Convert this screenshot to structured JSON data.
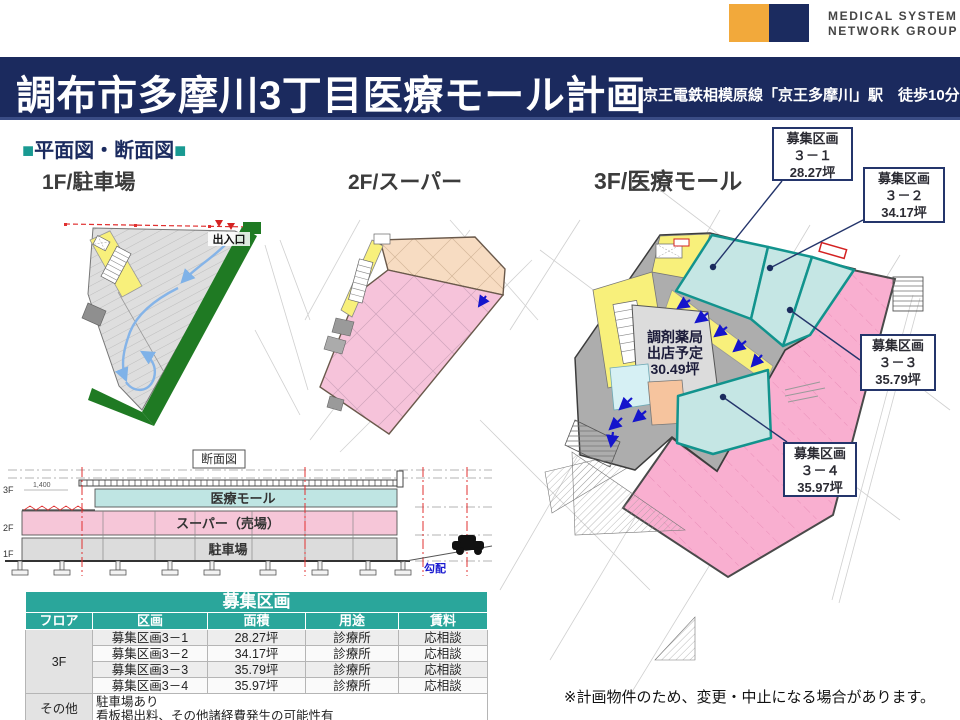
{
  "logo": {
    "line1": "MEDICAL SYSTEM",
    "line2": "NETWORK GROUP",
    "yellow": "#F2A93B",
    "navy": "#1B2B5F"
  },
  "banner": {
    "title": "調布市多摩川3丁目医療モール計画",
    "subtitle": "京王電鉄相模原線「京王多摩川」駅　徒歩10分",
    "bg": "#1B2A5E"
  },
  "section_heading": {
    "marker": "■",
    "label": "平面図・断面図"
  },
  "floor_labels": {
    "f1": "1F/駐車場",
    "f2": "2F/スーパー",
    "f3": "3F/医療モール"
  },
  "plan_1f": {
    "entrance_label": "出入口"
  },
  "plan_3f": {
    "pharmacy_line1": "調剤薬局",
    "pharmacy_line2": "出店予定",
    "pharmacy_line3": "30.49坪"
  },
  "callouts": [
    {
      "title": "募集区画",
      "no": "３－１",
      "area": "28.27坪"
    },
    {
      "title": "募集区画",
      "no": "３－２",
      "area": "34.17坪"
    },
    {
      "title": "募集区画",
      "no": "３－３",
      "area": "35.79坪"
    },
    {
      "title": "募集区画",
      "no": "３－４",
      "area": "35.97坪"
    }
  ],
  "cross_section": {
    "label": "断面図",
    "level3": "3F",
    "level2": "2F",
    "level1": "1F",
    "floor3": "医療モール",
    "floor2": "スーパー（売場）",
    "floor1": "駐車場",
    "slope_label": "勾配",
    "dim_label": "1,400"
  },
  "table": {
    "title": "募集区画",
    "headers": [
      "フロア",
      "区画",
      "面積",
      "用途",
      "賃料"
    ],
    "floor_group": "3F",
    "rows": [
      {
        "kukaku": "募集区画3－1",
        "menseki": "28.27坪",
        "yoto": "診療所",
        "chinryo": "応相談"
      },
      {
        "kukaku": "募集区画3－2",
        "menseki": "34.17坪",
        "yoto": "診療所",
        "chinryo": "応相談"
      },
      {
        "kukaku": "募集区画3－3",
        "menseki": "35.79坪",
        "yoto": "診療所",
        "chinryo": "応相談"
      },
      {
        "kukaku": "募集区画3－4",
        "menseki": "35.97坪",
        "yoto": "診療所",
        "chinryo": "応相談"
      }
    ],
    "other_label": "その他",
    "other_line1": "駐車場あり",
    "other_line2": "看板掲出料、その他諸経費発生の可能性有"
  },
  "footnote": "※計画物件のため、変更・中止になる場合があります。",
  "colors": {
    "teal": "#2AA69B",
    "navy": "#1B2A5E",
    "plan_pink": "#F9AFD0",
    "plan_cyan": "#C5E6E4",
    "plan_yellow": "#F8F07B",
    "plan_green": "#1F7A23"
  }
}
